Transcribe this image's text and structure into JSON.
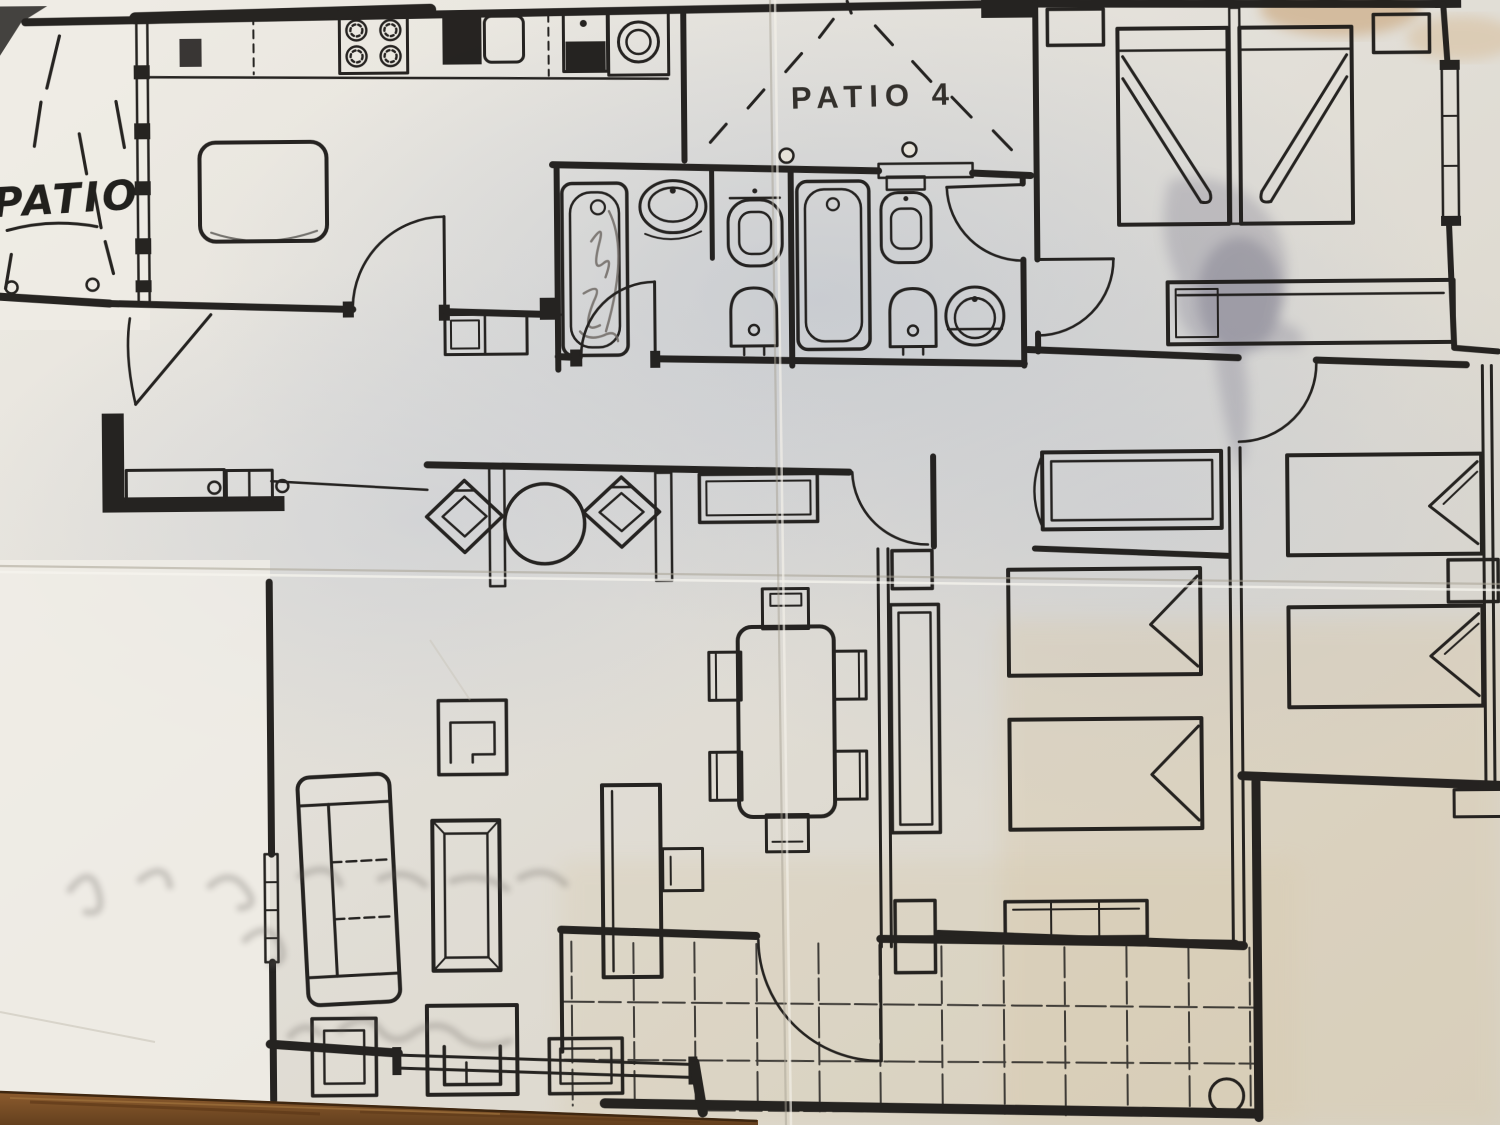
{
  "meta": {
    "kind": "photographed hand-drawn apartment floor plan on a wooden table"
  },
  "labels": {
    "patio_handwritten": "PATIO",
    "patio4_printed": "PATIO 4"
  },
  "colors": {
    "paper": "#e7e3da",
    "paper_shadow": "#c6c9d1",
    "paper_warm": "#d3c2a2",
    "ink": "#1c1a18",
    "pencil_scribble": "#6b6560",
    "ink_smudge": "#4e4a66",
    "coffee_stain": "#c79f6f",
    "crease": "#aaa496",
    "wood_table": "#7a4e24"
  }
}
